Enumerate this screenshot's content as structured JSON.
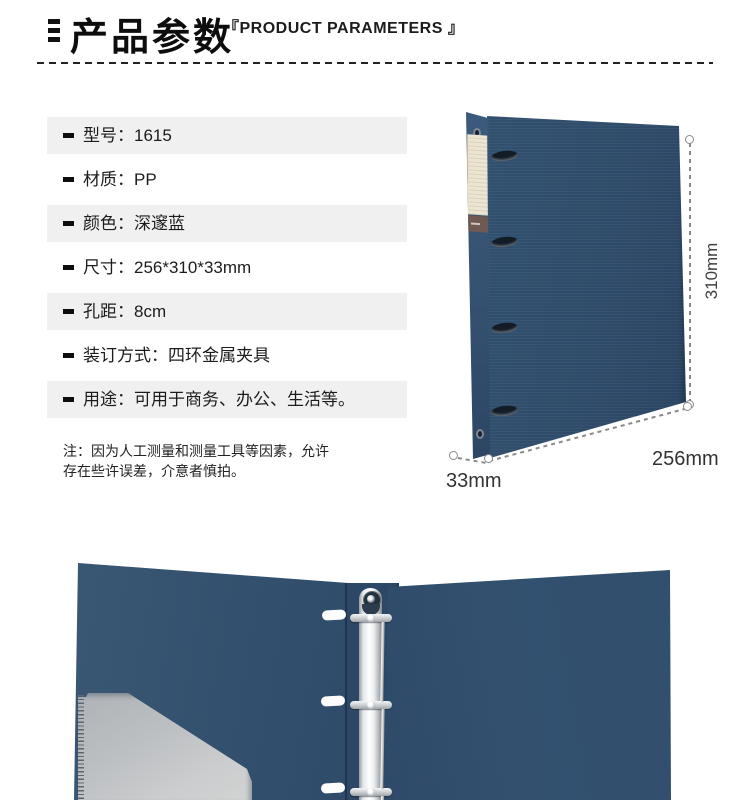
{
  "header": {
    "title": "产品参数",
    "subtitle": "『PRODUCT PARAMETERS 』"
  },
  "specs": {
    "items": [
      {
        "label": "型号：",
        "value": "1615"
      },
      {
        "label": "材质：",
        "value": "PP"
      },
      {
        "label": "颜色：",
        "value": "深邃蓝"
      },
      {
        "label": "尺寸：",
        "value": "256*310*33mm"
      },
      {
        "label": "孔距：",
        "value": "8cm"
      },
      {
        "label": "装订方式：",
        "value": "四环金属夹具"
      },
      {
        "label": "用途：",
        "value": "可用于商务、办公、生活等。"
      }
    ]
  },
  "note": {
    "line1": "注：因为人工测量和测量工具等因素，允许",
    "line2": "存在些许误差，介意者慎拍。"
  },
  "figure_closed": {
    "height_label": "310mm",
    "width_label": "256mm",
    "depth_label": "33mm"
  },
  "colors": {
    "binder_navy": "#2f4b6a",
    "row_gray": "#f0f0f0",
    "dimension_gray": "#8a8a8a",
    "spine_label_cream": "#ebe4d2",
    "spine_tag_brown": "#6f5a52",
    "ring_metal": "#d8dadc",
    "pocket_gray": "#bfc2c4"
  }
}
